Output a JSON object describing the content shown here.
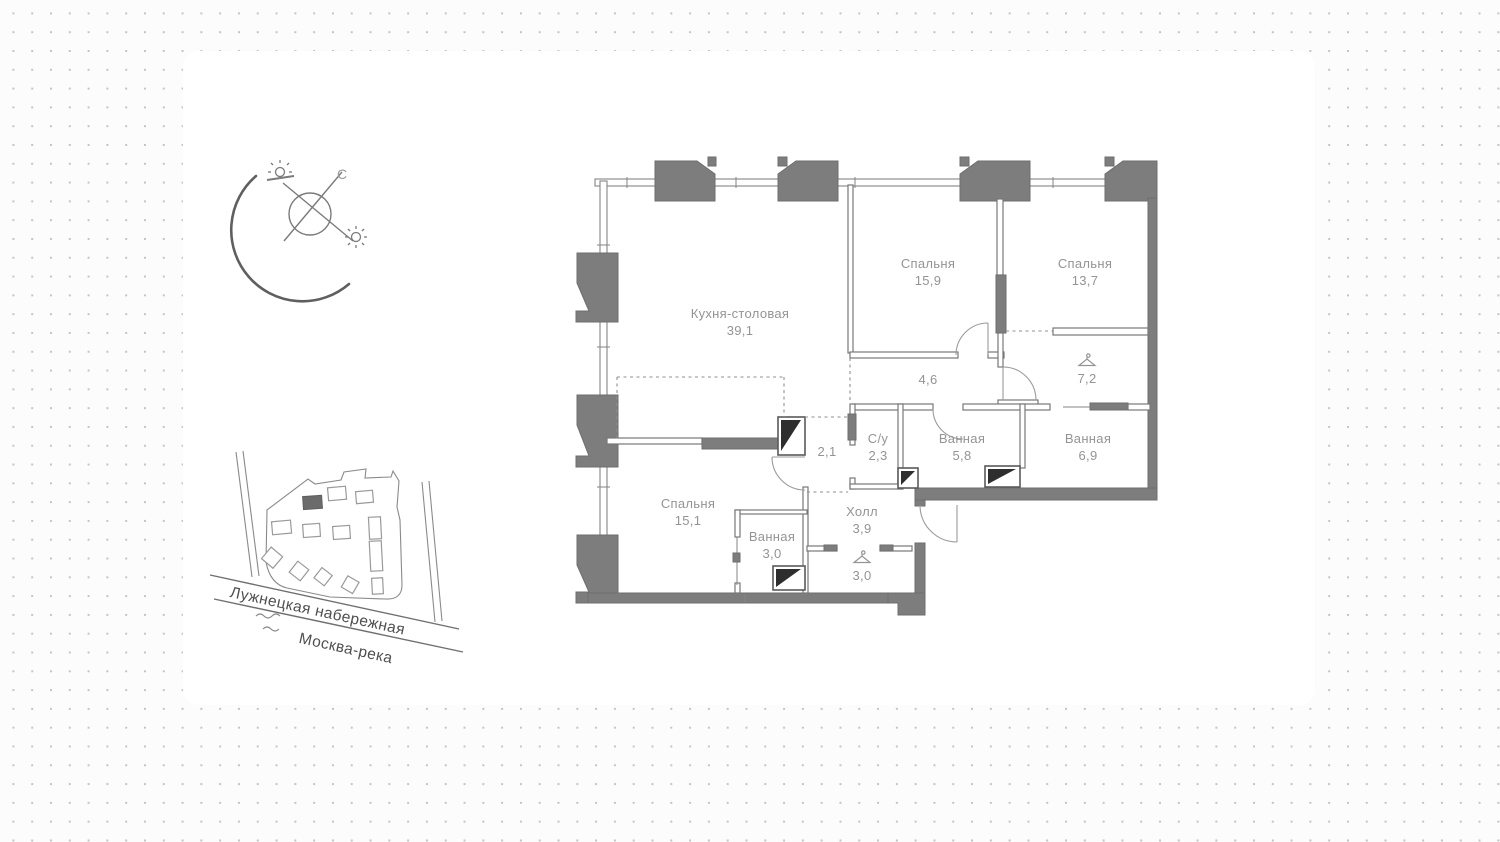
{
  "compass": {
    "north_label": "С"
  },
  "site_map": {
    "street_name": "Лужнецкая набережная",
    "river_name": "Москва-река"
  },
  "floor_plan": {
    "rooms": [
      {
        "name": "Кухня-столовая",
        "area": "39,1"
      },
      {
        "name": "Спальня",
        "area": "15,9"
      },
      {
        "name": "Спальня",
        "area": "13,7"
      },
      {
        "name": "",
        "area": "4,6"
      },
      {
        "name": "",
        "area": "7,2"
      },
      {
        "name": "",
        "area": "2,1"
      },
      {
        "name": "С/у",
        "area": "2,3"
      },
      {
        "name": "Ванная",
        "area": "5,8"
      },
      {
        "name": "Ванная",
        "area": "6,9"
      },
      {
        "name": "Спальня",
        "area": "15,1"
      },
      {
        "name": "Ванная",
        "area": "3,0"
      },
      {
        "name": "Холл",
        "area": "3,9"
      },
      {
        "name": "",
        "area": "3,0"
      }
    ]
  },
  "colors": {
    "wall": "#7d7d7d",
    "wall-dark": "#6e6e6e",
    "label": "#949494",
    "dot": "#c4c4c4",
    "map-text": "#4f4f4f"
  }
}
